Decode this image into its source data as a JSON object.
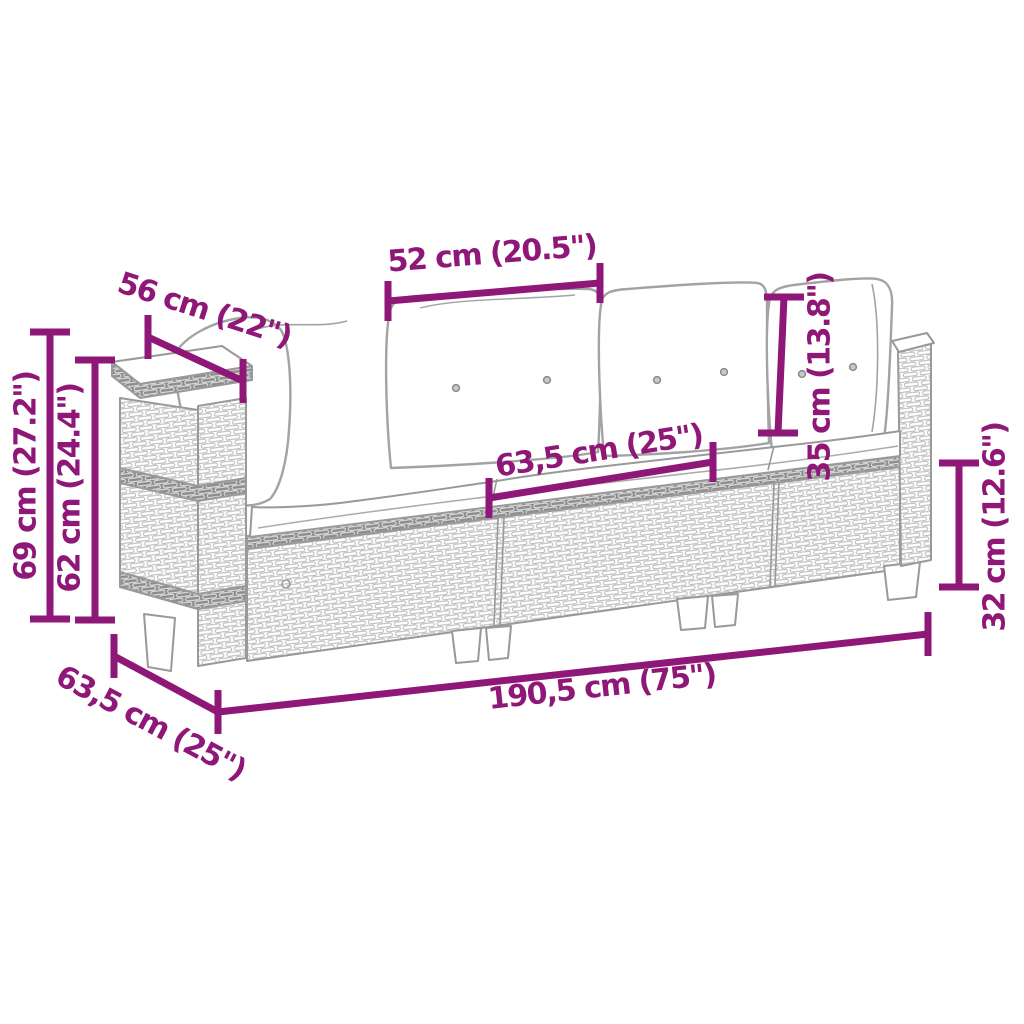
{
  "diagram": {
    "description": "Dimension sketch of a 3-seater poly rattan garden sofa with cushions",
    "background": "#ffffff",
    "accent_color": "#8e1777",
    "sketch_color": "#999999",
    "dimensions": {
      "back_cushion_width": "52 cm (20.5\")",
      "armrest_depth": "56 cm (22\")",
      "total_height": "69 cm (27.2\")",
      "back_height": "62 cm (24.4\")",
      "seat_module_width": "63,5 cm (25\")",
      "back_cushion_height": "35 cm (13.8\")",
      "seat_height": "32 cm (12.6\")",
      "total_width": "190,5 cm (75\")",
      "total_depth": "63,5 cm (25\")"
    }
  }
}
